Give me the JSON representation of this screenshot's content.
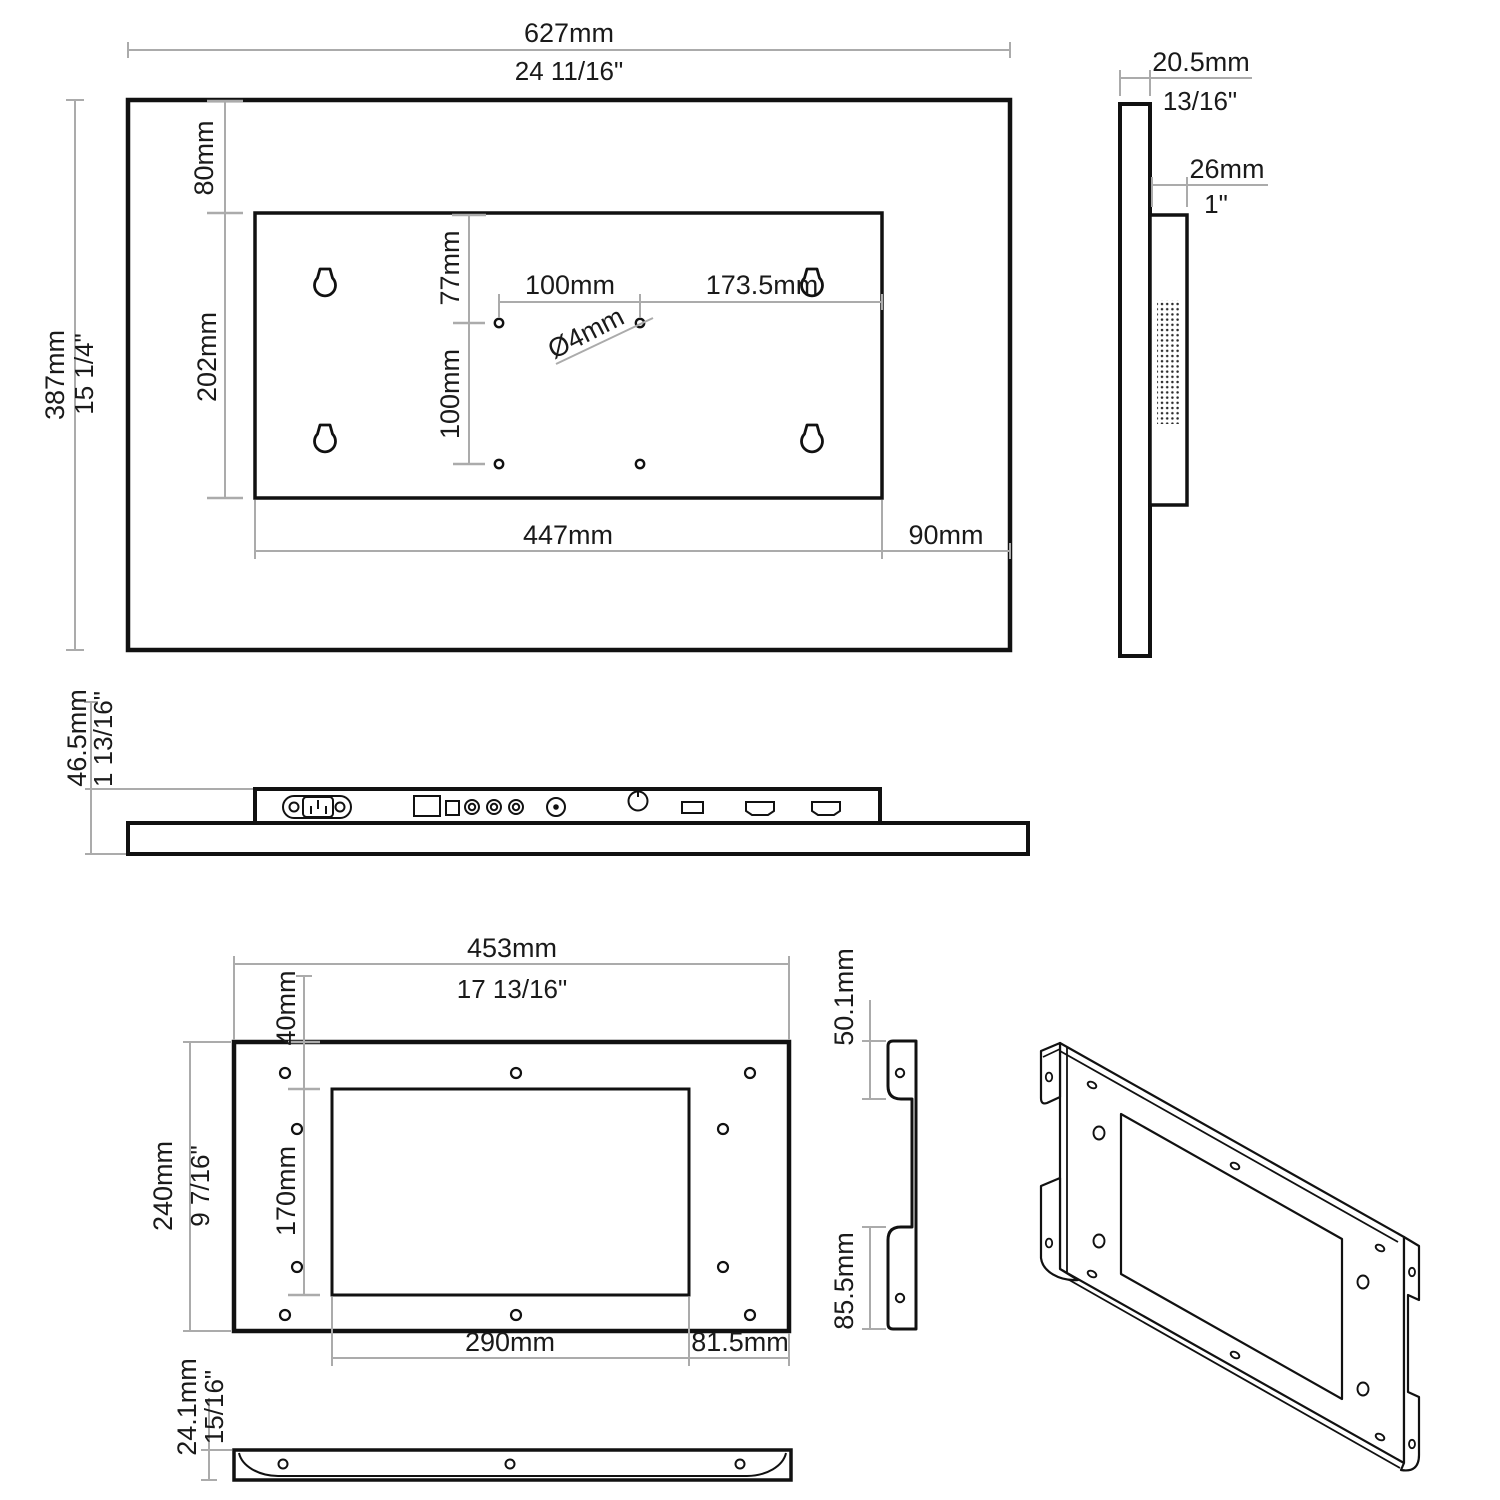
{
  "front": {
    "w_mm": "627mm",
    "w_in": "24 11/16\"",
    "h_mm": "387mm",
    "h_in": "15 1/4\"",
    "top_offset": "80mm",
    "box_h": "202mm",
    "hole_top": "77mm",
    "hole_v": "100mm",
    "hole_h": "100mm",
    "hole_right": "173.5mm",
    "hole_dia": "Ø4mm",
    "box_w": "447mm",
    "box_right": "90mm"
  },
  "side": {
    "t_mm": "20.5mm",
    "t_in": "13/16\"",
    "d_mm": "26mm",
    "d_in": "1\""
  },
  "bottom": {
    "h_mm": "46.5mm",
    "h_in": "1 13/16\""
  },
  "bracket": {
    "w_mm": "453mm",
    "w_in": "17 13/16\"",
    "top_offset": "40mm",
    "h_mm": "240mm",
    "h_in": "9 7/16\"",
    "open_h": "170mm",
    "open_w": "290mm",
    "right_offset": "81.5mm"
  },
  "bracket_side": {
    "top_flange": "50.1mm",
    "bottom_flange": "85.5mm"
  },
  "strip": {
    "h_mm": "24.1mm",
    "h_in": "15/16\""
  },
  "colors": {
    "line": "#111111",
    "dim": "#ababab",
    "bg": "#ffffff"
  }
}
